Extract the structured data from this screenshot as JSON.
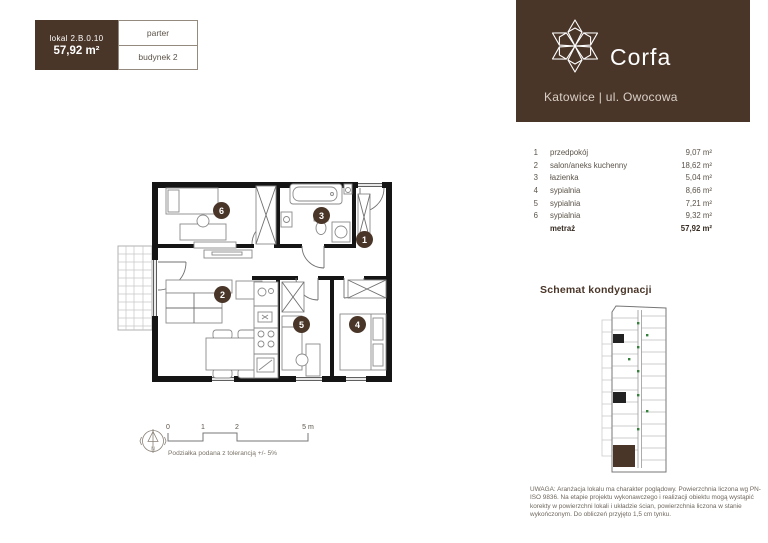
{
  "unit_card": {
    "lokal_label": "lokal  2.B.0.10",
    "area": "57,92 m²",
    "floor": "parter",
    "building": "budynek 2"
  },
  "brand": {
    "name": "Corfa",
    "location": "Katowice | ul. Owocowa"
  },
  "rooms": [
    {
      "num": "1",
      "name": "przedpokój",
      "area": "9,07 m²"
    },
    {
      "num": "2",
      "name": "salon/aneks kuchenny",
      "area": "18,62 m²"
    },
    {
      "num": "3",
      "name": "łazienka",
      "area": "5,04 m²"
    },
    {
      "num": "4",
      "name": "sypialnia",
      "area": "8,66 m²"
    },
    {
      "num": "5",
      "name": "sypialnia",
      "area": "7,21 m²"
    },
    {
      "num": "6",
      "name": "sypialnia",
      "area": "9,32 m²"
    }
  ],
  "total": {
    "label": "metraż",
    "value": "57,92 m²"
  },
  "schemat": {
    "title": "Schemat kondygnacji"
  },
  "plan": {
    "markers": [
      {
        "label": "1"
      },
      {
        "label": "2"
      },
      {
        "label": "3"
      },
      {
        "label": "4"
      },
      {
        "label": "5"
      },
      {
        "label": "6"
      }
    ]
  },
  "scale": {
    "ticks": [
      "0",
      "1",
      "2",
      "5 m"
    ],
    "note": "Podziałka podana z tolerancją +/- 5%"
  },
  "compass": {
    "label": "N"
  },
  "disclaimer": "UWAGA: Aranżacja lokalu ma charakter poglądowy. Powierzchnia liczona wg PN-ISO 9836. Na etapie projektu wykonawczego i realizacji obiektu mogą wystąpić korekty w powierzchni lokali i układzie ścian, powierzchnia liczona w stanie wykończonym. Do obliczeń przyjęto 1,5 cm tynku.",
  "colors": {
    "brand_brown": "#4a3629",
    "wall_black": "#151515",
    "schematic_dot_green": "#35803b"
  }
}
